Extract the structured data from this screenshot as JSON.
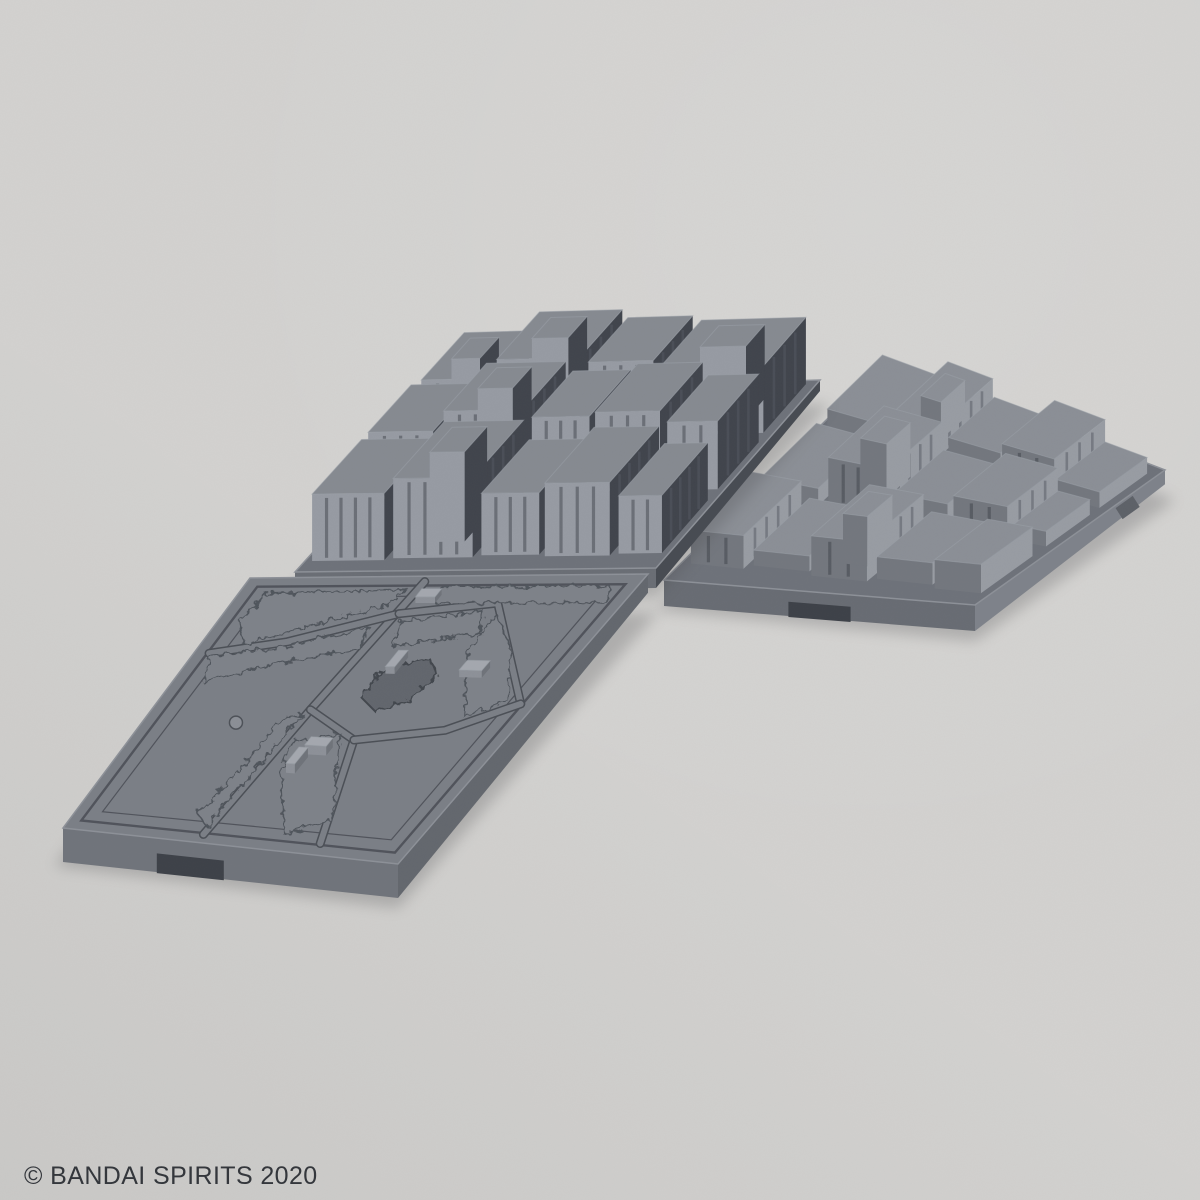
{
  "watermark": {
    "text": "© BANDAI SPIRITS 2020"
  },
  "scene": {
    "description": "Product photo of gray plastic model-kit diorama base tiles (two dense cityscape tiles and one flat park tile) connected together on a plain light-gray backdrop",
    "background": "#d3d2d0",
    "palette": {
      "backdrop": "#d3d2d0",
      "plastic_light": "#979ba3",
      "plastic_mid": "#7b7f86",
      "plastic_dark": "#40444c",
      "engraved_line": "#4b4f56",
      "watermark_text": "#34373c"
    },
    "tiles": [
      {
        "id": "city-tile-right",
        "label": "low-rise city blocks tile",
        "quad": [
          [
            885,
            362
          ],
          [
            1165,
            470
          ],
          [
            975,
            605
          ],
          [
            664,
            580
          ]
        ],
        "wallH": 26,
        "walls": {
          "front": "#686c73",
          "right": "#7e828a"
        },
        "notch": [
          0.4,
          0.6
        ],
        "tab": 0.74,
        "top": "#6e727a",
        "bcols": {
          "top": "#8b8f96",
          "front": "#73777e",
          "right": "#989ca3"
        },
        "stripeMin": 30,
        "buildings": [
          [
            0.03,
            0.05,
            0.22,
            0.3,
            26,
            0
          ],
          [
            0.24,
            0.02,
            0.4,
            0.28,
            38,
            1
          ],
          [
            0.42,
            0.04,
            0.6,
            0.26,
            22,
            0
          ],
          [
            0.62,
            0.02,
            0.8,
            0.28,
            40,
            0
          ],
          [
            0.82,
            0.05,
            0.97,
            0.3,
            20,
            0
          ],
          [
            0.03,
            0.35,
            0.22,
            0.6,
            18,
            0
          ],
          [
            0.24,
            0.32,
            0.44,
            0.58,
            48,
            1
          ],
          [
            0.46,
            0.34,
            0.64,
            0.58,
            24,
            0
          ],
          [
            0.66,
            0.32,
            0.84,
            0.58,
            34,
            0
          ],
          [
            0.86,
            0.35,
            0.97,
            0.58,
            16,
            0
          ],
          [
            0.03,
            0.65,
            0.2,
            0.92,
            30,
            0
          ],
          [
            0.22,
            0.64,
            0.4,
            0.9,
            14,
            0
          ],
          [
            0.42,
            0.64,
            0.6,
            0.92,
            36,
            1
          ],
          [
            0.62,
            0.63,
            0.8,
            0.9,
            20,
            0
          ],
          [
            0.82,
            0.65,
            0.97,
            0.92,
            26,
            0
          ]
        ]
      },
      {
        "id": "city-tile-left",
        "label": "high-rise city blocks tile",
        "quad": [
          [
            460,
            390
          ],
          [
            820,
            380
          ],
          [
            656,
            568
          ],
          [
            295,
            572
          ]
        ],
        "wallH": 20,
        "walls": {
          "left": "#4f535a",
          "front": "#6a6e75",
          "right": "#474b52"
        },
        "top": "#6e727a",
        "bcols": {
          "top": "#868a91",
          "front": "#979ba3",
          "right": "#40444c"
        },
        "stripeMin": 40,
        "buildings": [
          [
            0.03,
            0.04,
            0.21,
            0.3,
            80,
            1
          ],
          [
            0.23,
            0.02,
            0.46,
            0.28,
            100,
            1
          ],
          [
            0.48,
            0.03,
            0.66,
            0.27,
            92,
            0
          ],
          [
            0.68,
            0.02,
            0.97,
            0.28,
            84,
            1
          ],
          [
            0.02,
            0.34,
            0.2,
            0.6,
            70,
            0
          ],
          [
            0.22,
            0.32,
            0.44,
            0.58,
            88,
            1
          ],
          [
            0.46,
            0.32,
            0.62,
            0.57,
            78,
            0
          ],
          [
            0.64,
            0.32,
            0.82,
            0.58,
            84,
            0
          ],
          [
            0.84,
            0.33,
            0.98,
            0.58,
            72,
            0
          ],
          [
            0.02,
            0.64,
            0.22,
            0.94,
            60,
            0
          ],
          [
            0.24,
            0.62,
            0.46,
            0.93,
            72,
            1
          ],
          [
            0.48,
            0.63,
            0.64,
            0.92,
            56,
            0
          ],
          [
            0.66,
            0.63,
            0.84,
            0.93,
            66,
            0
          ],
          [
            0.86,
            0.64,
            0.98,
            0.92,
            52,
            0
          ]
        ]
      },
      {
        "id": "park-tile",
        "label": "flat park tile with walkways, trees, pond and fountain",
        "quad": [
          [
            250,
            578
          ],
          [
            648,
            574
          ],
          [
            398,
            864
          ],
          [
            63,
            828
          ]
        ],
        "wallH": 34,
        "walls": {
          "left": "#54585f",
          "front": "#70747b",
          "right": "#63676e"
        },
        "notch": [
          0.28,
          0.48
        ],
        "top": "#7b7f86",
        "park": {
          "frames": [
            0.035,
            0.075
          ],
          "paths": [
            [
              [
                0.45,
                0.02
              ],
              [
                0.42,
                0.5
              ],
              [
                0.4,
                0.97
              ]
            ],
            [
              [
                0.04,
                0.3
              ],
              [
                0.22,
                0.25
              ],
              [
                0.45,
                0.14
              ]
            ],
            [
              [
                0.45,
                0.14
              ],
              [
                0.68,
                0.1
              ],
              [
                0.96,
                0.45
              ]
            ],
            [
              [
                0.42,
                0.5
              ],
              [
                0.6,
                0.6
              ],
              [
                0.74,
                0.96
              ]
            ],
            [
              [
                0.6,
                0.6
              ],
              [
                0.82,
                0.55
              ],
              [
                0.96,
                0.45
              ]
            ]
          ],
          "bushes": [
            [
              [
                0.07,
                0.06
              ],
              [
                0.42,
                0.05
              ],
              [
                0.4,
                0.11
              ],
              [
                0.11,
                0.26
              ],
              [
                0.06,
                0.18
              ]
            ],
            [
              [
                0.05,
                0.31
              ],
              [
                0.22,
                0.27
              ],
              [
                0.4,
                0.19
              ],
              [
                0.42,
                0.27
              ],
              [
                0.24,
                0.33
              ],
              [
                0.08,
                0.41
              ]
            ],
            [
              [
                0.36,
                0.54
              ],
              [
                0.41,
                0.52
              ],
              [
                0.39,
                0.94
              ],
              [
                0.34,
                0.9
              ],
              [
                0.36,
                0.72
              ]
            ],
            [
              [
                0.47,
                0.17
              ],
              [
                0.66,
                0.13
              ],
              [
                0.7,
                0.21
              ],
              [
                0.5,
                0.26
              ]
            ],
            [
              [
                0.7,
                0.14
              ],
              [
                0.81,
                0.26
              ],
              [
                0.92,
                0.44
              ],
              [
                0.84,
                0.5
              ],
              [
                0.71,
                0.28
              ]
            ],
            [
              [
                0.44,
                0.62
              ],
              [
                0.55,
                0.58
              ],
              [
                0.72,
                0.88
              ],
              [
                0.62,
                0.94
              ],
              [
                0.47,
                0.72
              ]
            ],
            [
              [
                0.5,
                0.04
              ],
              [
                0.93,
                0.04
              ],
              [
                0.96,
                0.1
              ],
              [
                0.52,
                0.1
              ]
            ]
          ],
          "pond": [
            [
              0.55,
              0.33
            ],
            [
              0.62,
              0.3
            ],
            [
              0.68,
              0.36
            ],
            [
              0.66,
              0.45
            ],
            [
              0.6,
              0.5
            ],
            [
              0.53,
              0.45
            ],
            [
              0.52,
              0.37
            ]
          ],
          "fountain": [
            0.25,
            0.56
          ],
          "benches": [
            [
              0.47,
              0.07,
              0.52,
              0.1,
              8
            ],
            [
              0.54,
              0.3,
              0.565,
              0.36,
              8
            ],
            [
              0.74,
              0.33,
              0.8,
              0.365,
              8
            ],
            [
              0.5,
              0.63,
              0.56,
              0.66,
              9
            ],
            [
              0.49,
              0.67,
              0.515,
              0.73,
              9
            ]
          ]
        }
      }
    ]
  }
}
